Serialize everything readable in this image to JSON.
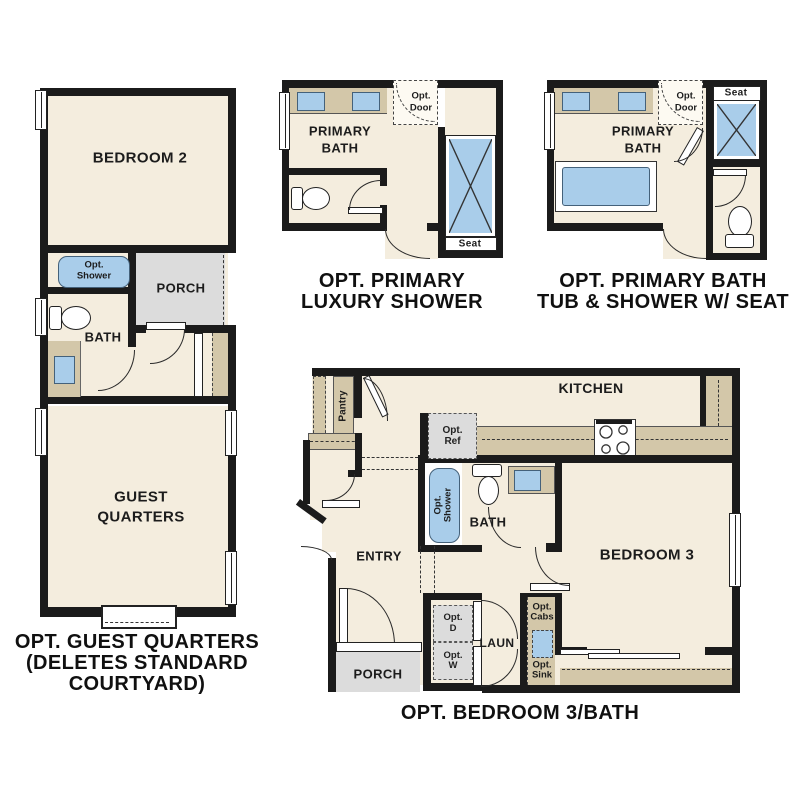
{
  "colors": {
    "room_fill": "#f4edde",
    "counter_tan": "#d3c7a9",
    "fixture_blue": "#a9cdea",
    "porch_gray": "#dcdcdc",
    "wall_black": "#1b1b1b"
  },
  "p1": {
    "bedroom2": "BEDROOM 2",
    "opt_shower_l1": "Opt.",
    "opt_shower_l2": "Shower",
    "porch": "PORCH",
    "bath": "BATH",
    "guest_l1": "GUEST",
    "guest_l2": "QUARTERS",
    "cap1": "OPT. GUEST QUARTERS",
    "cap2": "(DELETES STANDARD",
    "cap3": "COURTYARD)"
  },
  "p2": {
    "room_l1": "PRIMARY",
    "room_l2": "BATH",
    "opt_door_l1": "Opt.",
    "opt_door_l2": "Door",
    "seat": "Seat",
    "cap1": "OPT. PRIMARY",
    "cap2": "LUXURY SHOWER"
  },
  "p3": {
    "room_l1": "PRIMARY",
    "room_l2": "BATH",
    "opt_door_l1": "Opt.",
    "opt_door_l2": "Door",
    "seat": "Seat",
    "cap1": "OPT. PRIMARY BATH",
    "cap2": "TUB & SHOWER W/ SEAT"
  },
  "p4": {
    "kitchen": "KITCHEN",
    "pantry": "Pantry",
    "opt_ref_l1": "Opt.",
    "opt_ref_l2": "Ref",
    "opt_shower_l1": "Opt.",
    "opt_shower_l2": "Shower",
    "bath": "BATH",
    "entry": "ENTRY",
    "laun": "LAUN",
    "porch": "PORCH",
    "opt_d_l1": "Opt.",
    "opt_d_l2": "D",
    "opt_w_l1": "Opt.",
    "opt_w_l2": "W",
    "opt_cabs_l1": "Opt.",
    "opt_cabs_l2": "Cabs",
    "opt_sink_l1": "Opt.",
    "opt_sink_l2": "Sink",
    "bedroom3": "BEDROOM 3",
    "cap": "OPT. BEDROOM 3/BATH"
  }
}
